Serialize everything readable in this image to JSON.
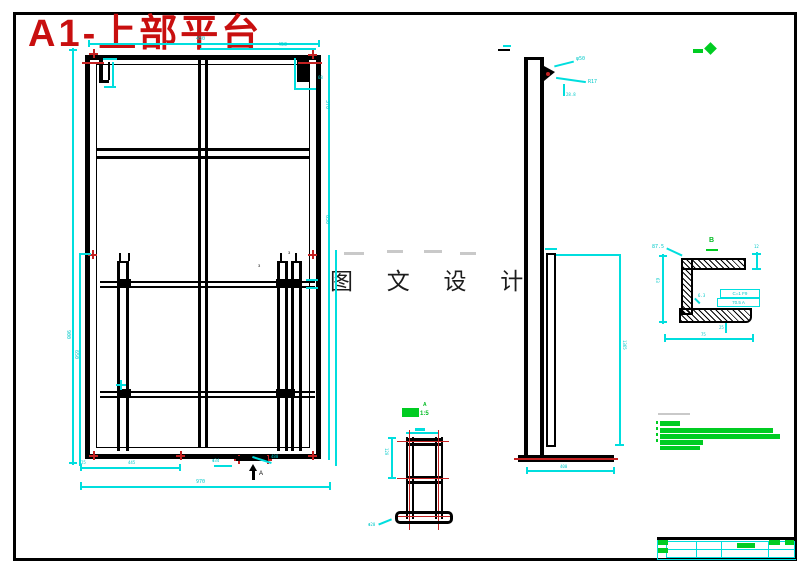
{
  "title": "A1-上部平台",
  "watermark": "图 文 设 计",
  "colors": {
    "line": "#000000",
    "dimension": "#00dede",
    "annotation_red": "#c42222",
    "annotation_green": "#00cc22"
  },
  "front_view": {
    "dims": {
      "top_left": "450",
      "top_right": "450",
      "left_outer": "900",
      "left_inner": "650",
      "right_upper": "370",
      "right_lower": "650",
      "corner": "68",
      "bottom_1": "25",
      "bottom_2": "445",
      "bottom_3": "Φ34",
      "bottom_4": "480",
      "bottom_total": "970",
      "gap_left": "3",
      "gap_right": "3"
    },
    "section_arrow": "A"
  },
  "side_view": {
    "dims": {
      "diameter": "φ50",
      "radius": "R17",
      "offset": "28.8",
      "height": "1365",
      "base": "400"
    }
  },
  "section_a": {
    "label": "A",
    "scale": "1:5",
    "dims": {
      "height": "120",
      "foot": "Φ20"
    }
  },
  "detail_b": {
    "label": "B",
    "dims": {
      "leader": "87.5",
      "flange": "12",
      "height": "63",
      "tol1": "C=1 F9",
      "tol2": "70.5 A",
      "rough": "6.3",
      "below": "25",
      "width": "75"
    }
  }
}
